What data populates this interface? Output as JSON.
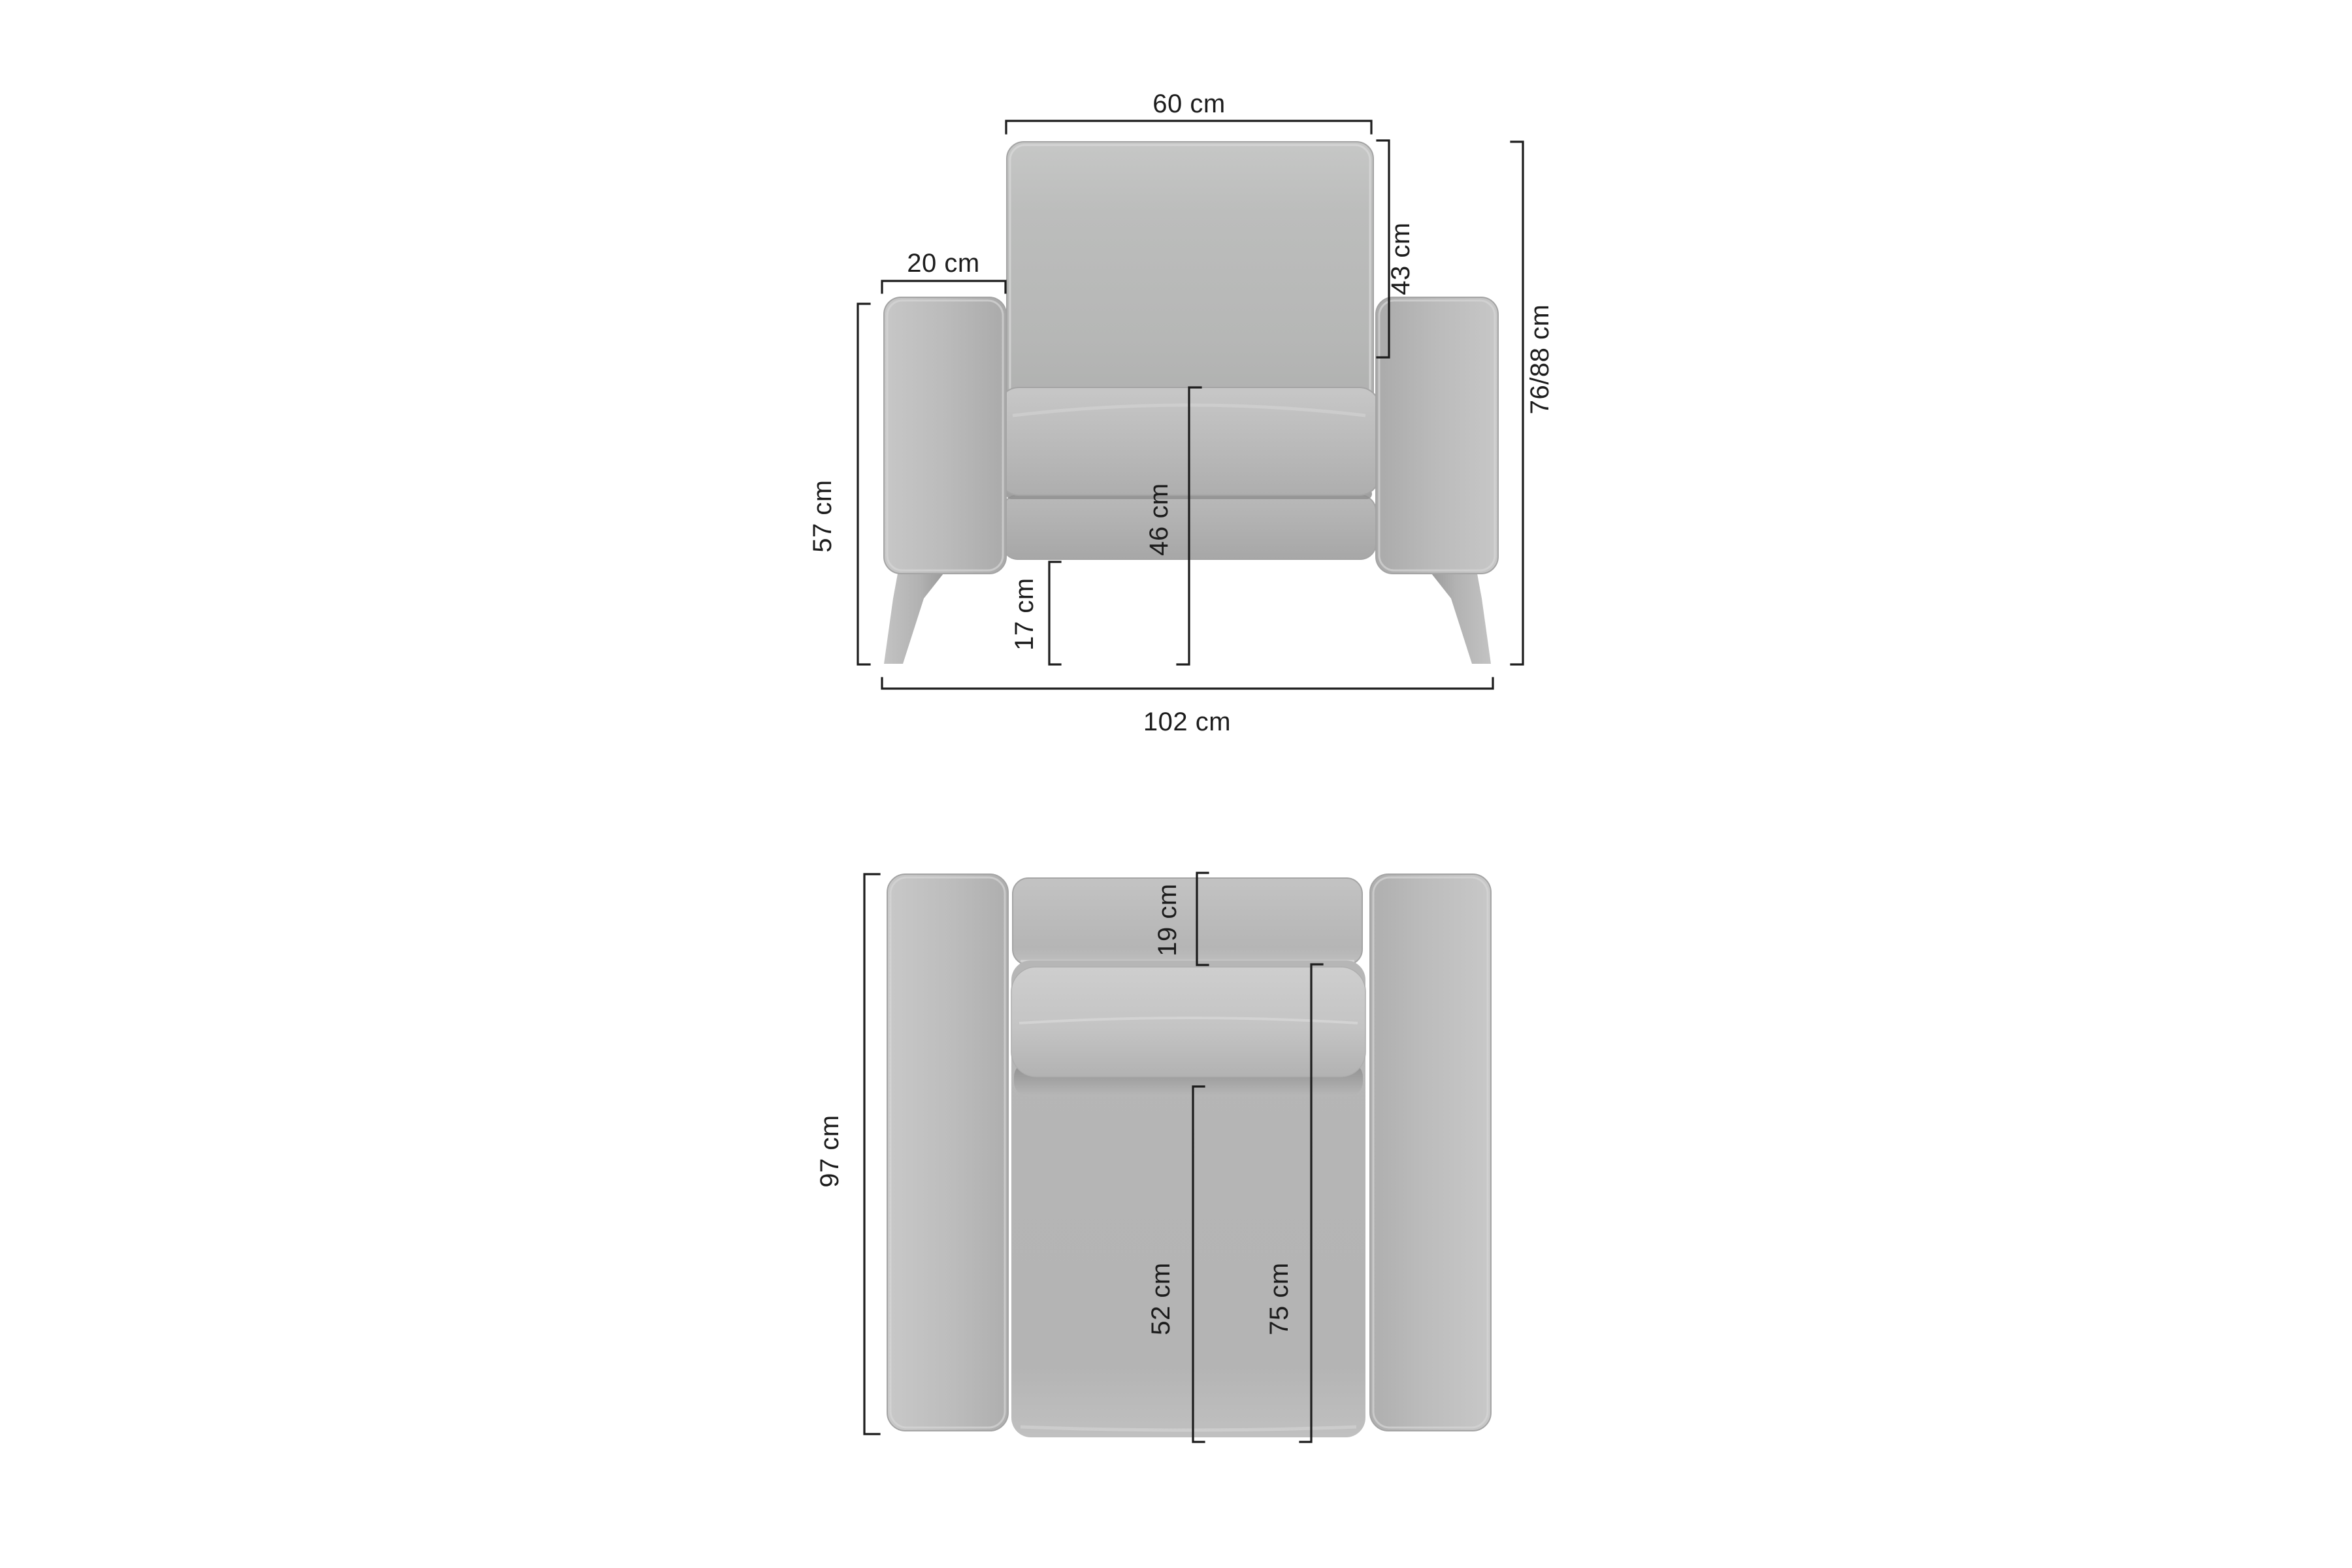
{
  "diagram": {
    "background_color": "#ffffff",
    "dimension_line_color": "#1c1c1c",
    "upholstery_color": "#b9b9b9",
    "upholstery_highlight_color": "#d8d8d8",
    "upholstery_shadow_color": "#8f8f8f",
    "leg_color": "#b0b0b0"
  },
  "front_view": {
    "dimensions": {
      "backrest_width": {
        "label": "60 cm"
      },
      "armrest_width": {
        "label": "20 cm"
      },
      "backrest_height": {
        "label": "43 cm"
      },
      "overall_height": {
        "label": "76/88 cm"
      },
      "armrest_height": {
        "label": "57 cm"
      },
      "seat_height": {
        "label": "46 cm"
      },
      "leg_height": {
        "label": "17 cm"
      },
      "overall_width": {
        "label": "102 cm"
      }
    }
  },
  "top_view": {
    "dimensions": {
      "backrest_depth": {
        "label": "19 cm"
      },
      "overall_depth": {
        "label": "97 cm"
      },
      "seat_depth": {
        "label": "52 cm"
      },
      "inner_depth": {
        "label": "75 cm"
      }
    }
  }
}
